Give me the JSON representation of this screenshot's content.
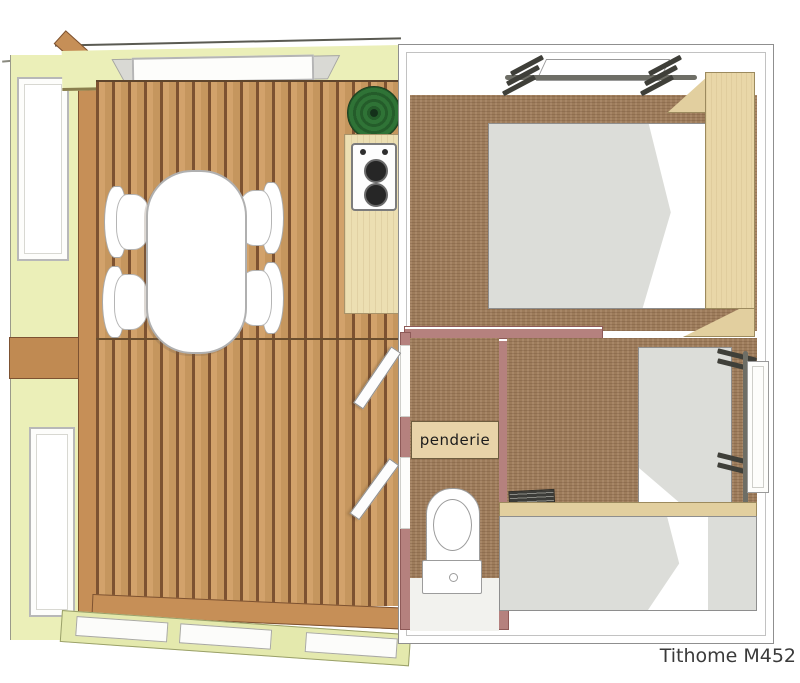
{
  "caption": "Tithome M452",
  "labels": {
    "penderie": "penderie"
  },
  "plan": {
    "model": "Tithome M452",
    "rooms": [
      "terrace-dining-deck",
      "kitchenette",
      "double-bedroom",
      "hallway",
      "wc-bathroom",
      "twin-bedroom"
    ],
    "furniture": [
      "oval-dining-table",
      "chairs",
      "green-sink-basin",
      "two-burner-stove",
      "kitchen-counter",
      "double-bed",
      "tall-wardrobe",
      "fold-up-bunk-top",
      "penderie-wardrobe",
      "toilet",
      "single-bed-vertical",
      "single-bed-horizontal",
      "fold-up-bunk-right",
      "luggage-rack"
    ],
    "counts": {
      "chairs": 4,
      "beds": 3,
      "stove_burners": 2,
      "open_doors": 3,
      "windows": 5
    }
  },
  "colors": {
    "deck_plank": "#d2a26b",
    "plank_gap": "#7d5231",
    "wall_yellow": "#ebefb8",
    "carpet_brown": "#a3815f",
    "wall_mauve": "#b5817e",
    "wood_tan": "#e9d7a8",
    "mattress_grey": "#dcddd9",
    "basin_green": "#2d6e34",
    "caption_text": "#3a3a3a"
  }
}
